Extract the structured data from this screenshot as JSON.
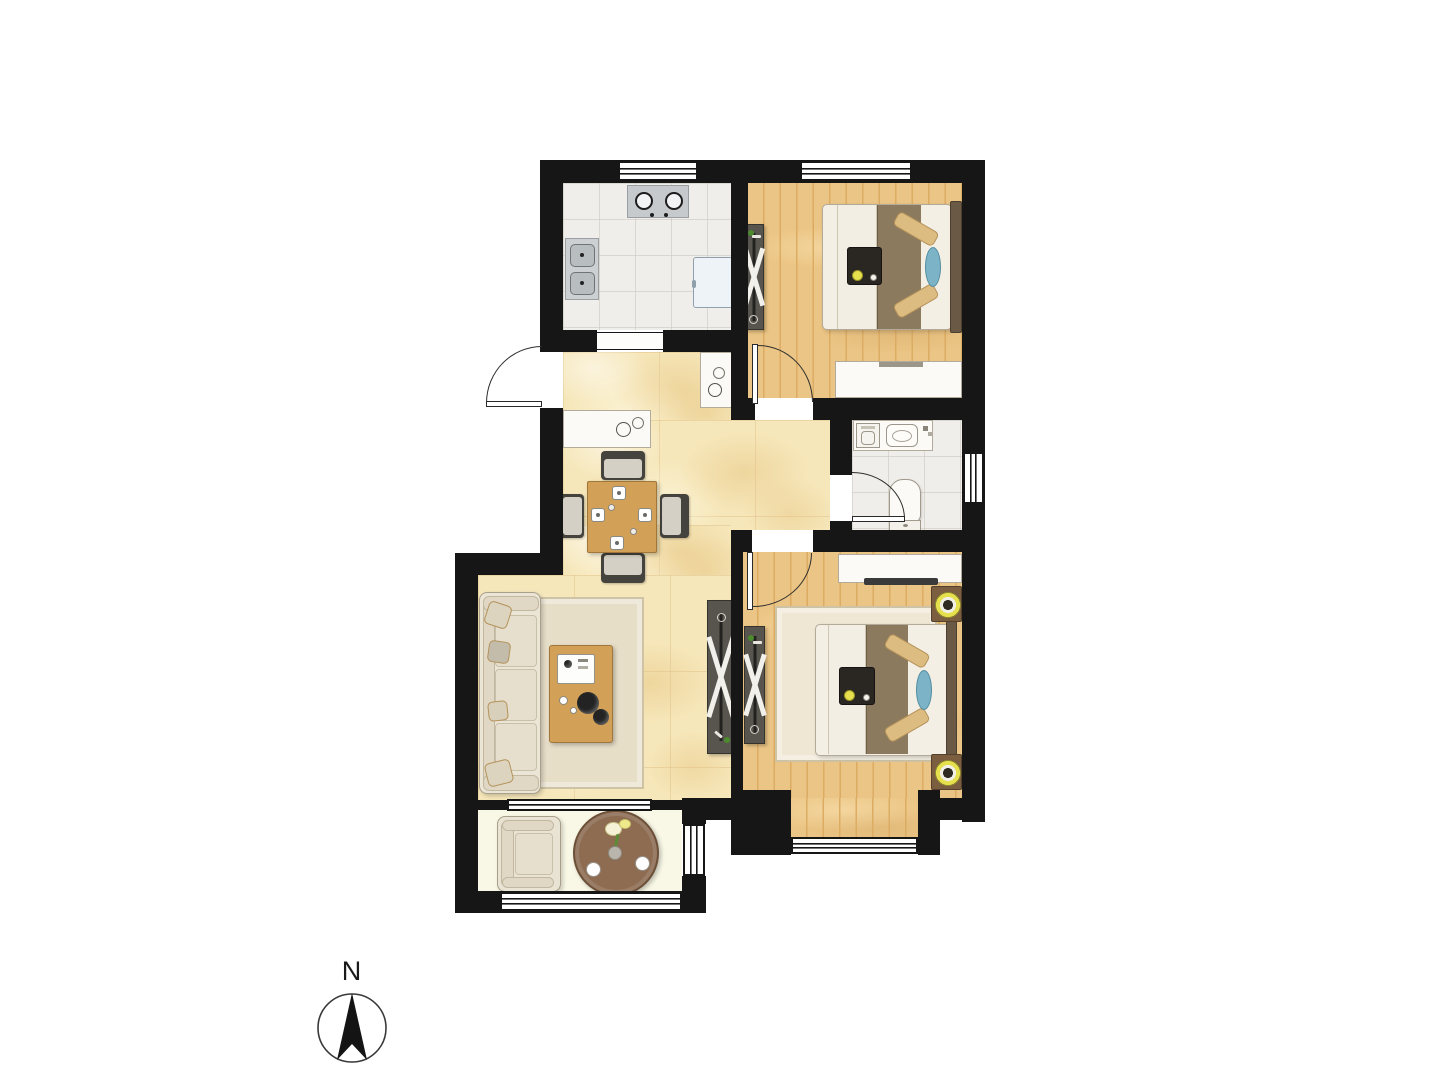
{
  "canvas": {
    "width": 1440,
    "height": 1080,
    "background": "#ffffff"
  },
  "compass": {
    "label": "N",
    "direction": "up"
  },
  "colors": {
    "wall": "#161616",
    "tile": "#f0eeea",
    "marble": "#f6e7ba",
    "wood": "#ebc585",
    "wood-line": "#dcac62",
    "balcony-floor": "#f9f8e6",
    "white-furn": "#fbfaf6",
    "furn-border": "#b2aa9b",
    "wood-furn": "#d2a057",
    "wood-furn-dark": "#a0763a",
    "wardrobe": "#57554e",
    "blanket": "#8c7a5f",
    "sheet": "#f3efe5",
    "pillow": "#dcbc80",
    "pillow-border": "#b5925a",
    "accent-blue": "#7cb3c6",
    "lamp-yellow": "#e6e04e",
    "rug": "#e7dec8",
    "rug-border": "#cfc3a5",
    "chair": "#45433d",
    "chair-seat": "#d4d0c6",
    "plant-green": "#4c8b2d",
    "table-brown": "#8d6c52"
  },
  "floor_plan": {
    "type": "apartment-2-bedroom",
    "rooms": [
      {
        "name": "kitchen",
        "floor": "tile",
        "furniture": [
          "gas-cooktop-2-burner",
          "double-basin-sink",
          "refrigerator"
        ],
        "windows": 1,
        "openings": [
          "sliding-opening-to-hall"
        ]
      },
      {
        "name": "bedroom-1",
        "floor": "wood",
        "furniture": [
          "wardrobe",
          "double-bed",
          "bed-tray",
          "dresser"
        ],
        "windows": 1,
        "doors": [
          "hinged-door-to-hall"
        ]
      },
      {
        "name": "bathroom",
        "floor": "tile",
        "furniture": [
          "washing-machine",
          "vanity-sink",
          "toilet"
        ],
        "windows": 1,
        "doors": [
          "hinged-door-to-hall"
        ]
      },
      {
        "name": "hallway-dining",
        "floor": "marble-tile",
        "furniture": [
          "sideboard",
          "shoe-cabinet",
          "dining-table-for-four",
          "hall-wardrobe"
        ],
        "doors": [
          "entry-door"
        ]
      },
      {
        "name": "living-room",
        "floor": "marble-tile",
        "furniture": [
          "sofa",
          "area-rug",
          "coffee-table"
        ],
        "openings": [
          "sliding-window-to-balcony"
        ]
      },
      {
        "name": "bedroom-2",
        "floor": "wood",
        "furniture": [
          "tv-cabinet",
          "wardrobe",
          "double-bed",
          "bed-tray",
          "nightstand-with-lamp",
          "nightstand-with-lamp",
          "area-rug"
        ],
        "windows": 1,
        "doors": [
          "hinged-door-to-hall"
        ]
      },
      {
        "name": "balcony",
        "floor": "tile",
        "furniture": [
          "armchair",
          "round-tea-table"
        ],
        "windows": 3
      }
    ],
    "entry": {
      "type": "entry-door",
      "wall": "west",
      "swing": "outward"
    }
  }
}
